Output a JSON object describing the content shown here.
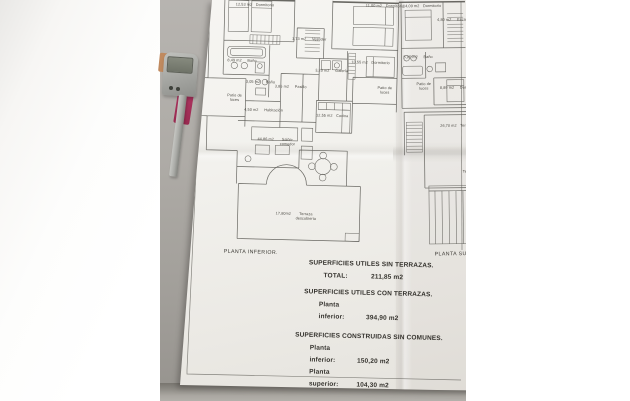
{
  "scene": {
    "description": "photo of architectural floor plan document on desk",
    "paper_color": "#f2f1ed",
    "desk_color": "#a8a5a0",
    "card_color": "#a93058",
    "device_color": "#a7a8a4",
    "orange_tab_color": "#c08a5f",
    "overexposed_color": "#ffffff"
  },
  "plans": {
    "inferior": {
      "label": "PLANTA INFERIOR.",
      "rooms": [
        {
          "name": "Dormitorio",
          "area": "12,53 m2",
          "x": 233,
          "y": 4
        },
        {
          "name": "Dormitorio",
          "area": "11,00 m2",
          "x": 363,
          "y": 2
        },
        {
          "name": "Vestidor",
          "area": "1,73 m2",
          "x": 290,
          "y": 37
        },
        {
          "name": "Baño",
          "area": "8,49 m2",
          "x": 226,
          "y": 60
        },
        {
          "name": "Dormitorio",
          "area": "10,55 m2",
          "x": 350,
          "y": 59
        },
        {
          "name": "Galería",
          "area": "3,20 m2",
          "x": 314,
          "y": 68
        },
        {
          "name": "Patio de luces",
          "area": "",
          "x": 204,
          "y": 95
        },
        {
          "name": "Baño",
          "area": "3,05 m2",
          "x": 245,
          "y": 81
        },
        {
          "name": "Pasillo",
          "area": "3,85 m2",
          "x": 274,
          "y": 85
        },
        {
          "name": "Habitación",
          "area": "4,50 m2",
          "x": 244,
          "y": 109
        },
        {
          "name": "Cocina",
          "area": "12,55 m2",
          "x": 316,
          "y": 113
        },
        {
          "name": "Patio de luces",
          "area": "",
          "x": 354,
          "y": 84
        },
        {
          "name": "Salón-comedor",
          "area": "44,86 m2",
          "x": 258,
          "y": 138
        },
        {
          "name": "Terraza descubierta",
          "area": "17,80m2",
          "x": 278,
          "y": 212
        }
      ]
    },
    "superior": {
      "label": "PLANTA SUPERIOR.",
      "rooms": [
        {
          "name": "Dormitorio",
          "area": "14,09 m2",
          "x": 404,
          "y": 4
        },
        {
          "name": "Escalera",
          "area": "4,80 m2",
          "x": 438,
          "y": 18
        },
        {
          "name": "Baño",
          "area": "5,05 m2",
          "x": 404,
          "y": 55
        },
        {
          "name": "Patio de luces",
          "area": "",
          "x": 394,
          "y": 82
        },
        {
          "name": "Dormitorio",
          "area": "8,89 m2",
          "x": 440,
          "y": 86
        },
        {
          "name": "Terraza",
          "area": "26,70 m2",
          "x": 440,
          "y": 124
        },
        {
          "name": "Terraza",
          "area": "",
          "x": 442,
          "y": 170
        }
      ]
    }
  },
  "summary": {
    "sections": [
      {
        "heading": "SUPERFICIES UTILES SIN TERRAZAS.",
        "rows": [
          {
            "label": "TOTAL:",
            "value": "211,85 m2"
          }
        ]
      },
      {
        "heading": "SUPERFICIES UTILES CON TERRAZAS.",
        "rows": [
          {
            "label": "Planta inferior:",
            "value": "394,90 m2"
          }
        ]
      },
      {
        "heading": "SUPERFICIES CONSTRUIDAS SIN COMUNES.",
        "rows": [
          {
            "label": "Planta inferior:",
            "value": "150,20 m2"
          },
          {
            "label": "Planta superior:",
            "value": "104,30 m2"
          },
          {
            "label": "TOTAL:",
            "value": "254,50 m2"
          }
        ]
      }
    ]
  }
}
